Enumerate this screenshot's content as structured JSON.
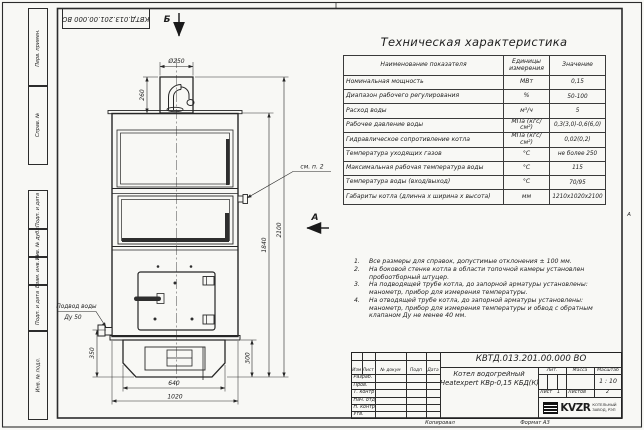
{
  "sheet": {
    "doc_number_top": "КВТД.013.201.00.000 ВО",
    "copied_label": "Копировал",
    "format_label": "Формат А3",
    "zone_letter": "А"
  },
  "left_margin": {
    "cells": [
      {
        "label": "Перв. примен."
      },
      {
        "label": "Справ. №"
      },
      {
        "label": "Подп. и дата"
      },
      {
        "label": "Инв. № дубл."
      },
      {
        "label": "Взам. инв. №"
      },
      {
        "label": "Подп. и дата"
      },
      {
        "label": "Инв. № подл."
      }
    ]
  },
  "drawing": {
    "section_arrow": "Б",
    "view_arrow": "А",
    "see_note_label": "см. п. 2",
    "water_inlet_line1": "Подвод воды",
    "water_inlet_line2": "Ду 50",
    "dims": {
      "chimney_dia": "Ø250",
      "chimney_h": "260",
      "body_h": "1840",
      "total_h": "2100",
      "inlet_h": "350",
      "base_h": "300",
      "base_w": "640",
      "total_w": "1020"
    }
  },
  "spec_table": {
    "title": "Техническая характеристика",
    "col_name": "Наименование показателя",
    "col_unit": "Единицы измерения",
    "col_value": "Значение",
    "rows": [
      {
        "name": "Номинальная мощность",
        "unit": "МВт",
        "value": "0,15"
      },
      {
        "name": "Диапазон рабочего регулирования",
        "unit": "%",
        "value": "50-100"
      },
      {
        "name": "Расход воды",
        "unit": "м³/ч",
        "value": "5"
      },
      {
        "name": "Рабочее давление воды",
        "unit": "МПа (кгс/см²)",
        "value": "0,3(3,0)-0,6(6,0)"
      },
      {
        "name": "Гидравлическое сопротивление котла",
        "unit": "МПа (кгс/см²)",
        "value": "0,02(0,2)"
      },
      {
        "name": "Температура уходящих газов",
        "unit": "°С",
        "value": "не более 250"
      },
      {
        "name": "Максимальная рабочая температура воды",
        "unit": "°С",
        "value": "115"
      },
      {
        "name": "Температура воды (вход/выход)",
        "unit": "°С",
        "value": "70/95"
      },
      {
        "name": "Габариты котла (длинна х ширина х высота)",
        "unit": "мм",
        "value": "1210х1020х2100"
      }
    ]
  },
  "notes": [
    {
      "num": "1.",
      "text": "Все размеры для справок, допустимые отклонения ± 100 мм."
    },
    {
      "num": "2.",
      "text": "На боковой стенке котла в области топочной камеры установлен пробоотборный штуцер."
    },
    {
      "num": "3.",
      "text": "На подводящей трубе котла, до запорной арматуры установлены: манометр, прибор для измерения температуры."
    },
    {
      "num": "4.",
      "text": "На отводящей трубе котла, до запорной арматуры установлены: манометр, прибор для измерения температуры и обвод с обратным клапаном Ду не менее 40 мм."
    }
  ],
  "title_block": {
    "doc_number": "КВТД.013.201.00.000 ВО",
    "product_line1": "Котел водогрейный",
    "product_line2": "Heatexpert КВр-0,15 КБД(К)",
    "cols": [
      "Изм",
      "Лист",
      "№ докум",
      "Подп",
      "Дата"
    ],
    "row_labels": [
      "Разраб.",
      "Пров.",
      "Т. контр",
      "Нач. отд",
      "Н. контр",
      "Утв."
    ],
    "lit_label": "Лит.",
    "mass_label": "Масса",
    "scale_label": "Масштаб",
    "scale_value": "1 : 10",
    "sheet_label": "Лист",
    "sheet_value": "1",
    "sheets_label": "Листов",
    "sheets_value": "2",
    "logo_text": "KVZR",
    "company_line1": "КОТЕЛЬНЫЙ",
    "company_line2": "ЗАВОД, РЭП"
  }
}
